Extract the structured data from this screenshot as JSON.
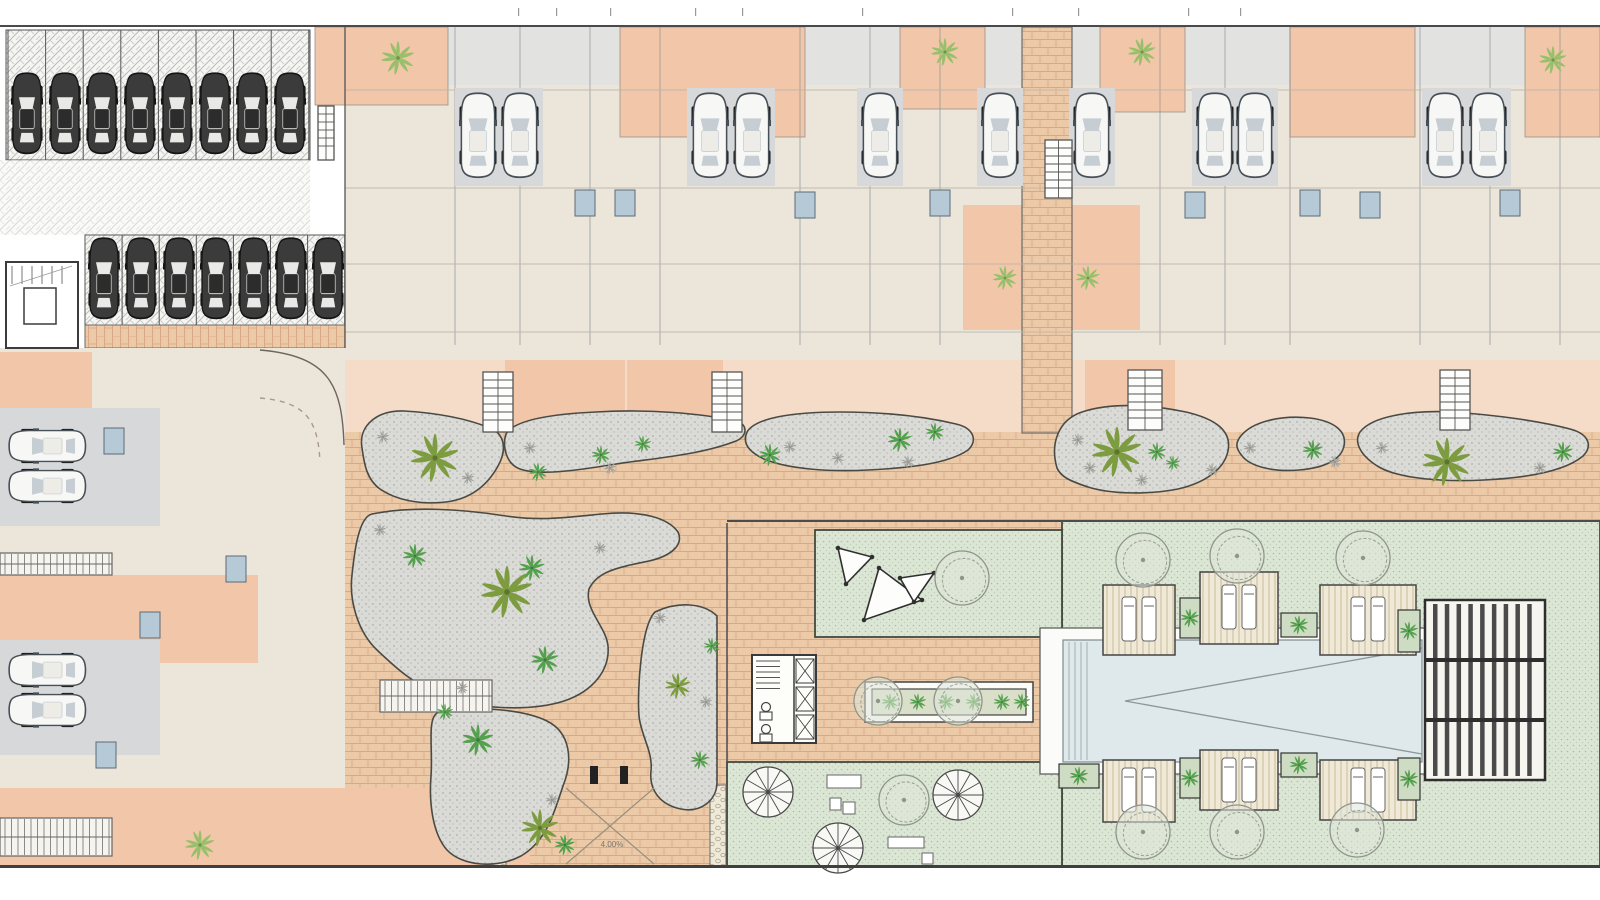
{
  "title": "Residential development site plan – ground floor",
  "canvas": {
    "w": 1600,
    "h": 900
  },
  "palette": {
    "paper": "#ffffff",
    "beige": "#ebe5da",
    "grayLight": "#e2e2e0",
    "gray": "#d7d8da",
    "salmon": "#f1c6a9",
    "salmonLight": "#f5dcc9",
    "blue": "#b5c9d6",
    "brickFill": "#ecca/a8",
    "brick": "#eccaa8",
    "brickLine": "#d9a987",
    "gravel": "#dadad6",
    "gravelDot": "#b0b0ac",
    "gravelStroke": "#4a4a45",
    "lawn": "#dce6d5",
    "lawnDot": "#a8bfa3",
    "lawnStroke": "#44493f",
    "pool": "#dfe9ec",
    "deck": "#f0e9d8",
    "deckLine": "#c8ba99",
    "pebble": "#efe9da",
    "olive": "#7d9c40",
    "green2": "#55a04e",
    "green3": "#98c06a",
    "shrubGray": "#a3a39d",
    "wall": "#63686f",
    "carDark": "#3b3b3b",
    "carLight": "#f7f7f5"
  },
  "labels": [
    {
      "x": 612,
      "y": 847,
      "text": "4.00%"
    }
  ],
  "borders": {
    "top_y": 26,
    "bottom_y": 866.5
  },
  "zones": [
    {
      "n": "plan-paper",
      "x": 0,
      "y": 25,
      "w": 1600,
      "h": 843,
      "f": "paper"
    },
    {
      "n": "parking-garage-floor",
      "x": 0,
      "y": 27,
      "w": 345,
      "h": 321,
      "f": "paper"
    },
    {
      "n": "parking-row1-paving",
      "x": 6,
      "y": 30,
      "w": 304,
      "h": 130,
      "t": "hatch",
      "sw": 1,
      "sc": "#555"
    },
    {
      "n": "parking-aisle-paving",
      "x": 0,
      "y": 160,
      "w": 310,
      "h": 75,
      "t": "hatch",
      "o": 0.55
    },
    {
      "n": "parking-row2-paving",
      "x": 85,
      "y": 235,
      "w": 260,
      "h": 90,
      "t": "hatch",
      "sw": 1,
      "sc": "#555"
    },
    {
      "n": "paver-strip",
      "x": 85,
      "y": 325,
      "w": 260,
      "h": 23,
      "t": "brickV",
      "sw": 1,
      "sc": "#6b6b66"
    },
    {
      "n": "top-units-floor",
      "x": 345,
      "y": 27,
      "w": 1255,
      "h": 333,
      "f": "beige"
    },
    {
      "n": "top-terrace-strip",
      "x": 345,
      "y": 27,
      "w": 1255,
      "h": 58,
      "f": "grayLight"
    },
    {
      "n": "patio",
      "x": 315,
      "y": 27,
      "w": 133,
      "h": 78,
      "f": "salmon",
      "sw": 0.8,
      "sc": "#999288"
    },
    {
      "n": "patio",
      "x": 620,
      "y": 27,
      "w": 185,
      "h": 110,
      "f": "salmon",
      "sw": 0.8,
      "sc": "#999288"
    },
    {
      "n": "patio",
      "x": 900,
      "y": 27,
      "w": 85,
      "h": 82,
      "f": "salmon",
      "sw": 0.8,
      "sc": "#999288"
    },
    {
      "n": "patio",
      "x": 1100,
      "y": 27,
      "w": 85,
      "h": 85,
      "f": "salmon",
      "sw": 0.8,
      "sc": "#999288"
    },
    {
      "n": "patio",
      "x": 1290,
      "y": 27,
      "w": 125,
      "h": 110,
      "f": "salmon",
      "sw": 0.8,
      "sc": "#999288"
    },
    {
      "n": "patio",
      "x": 1525,
      "y": 27,
      "w": 75,
      "h": 110,
      "f": "salmon",
      "sw": 0.8,
      "sc": "#999288"
    },
    {
      "n": "courtyard",
      "x": 963,
      "y": 205,
      "w": 60,
      "h": 125,
      "f": "salmon"
    },
    {
      "n": "courtyard",
      "x": 1072,
      "y": 205,
      "w": 68,
      "h": 125,
      "f": "salmon"
    },
    {
      "n": "rear-yard-band",
      "x": 345,
      "y": 360,
      "w": 1255,
      "h": 72,
      "f": "salmonLight"
    },
    {
      "n": "rear-yard",
      "x": 505,
      "y": 360,
      "w": 120,
      "h": 72,
      "f": "salmon"
    },
    {
      "n": "rear-yard",
      "x": 627,
      "y": 360,
      "w": 96,
      "h": 72,
      "f": "salmon"
    },
    {
      "n": "rear-yard",
      "x": 1085,
      "y": 360,
      "w": 90,
      "h": 72,
      "f": "salmon"
    },
    {
      "n": "promenade-paving",
      "x": 345,
      "y": 432,
      "w": 1255,
      "h": 91,
      "t": "brick"
    },
    {
      "n": "garden-path-paving",
      "x": 345,
      "y": 523,
      "w": 382,
      "h": 345,
      "t": "brick"
    },
    {
      "n": "pool-path-paving",
      "x": 727,
      "y": 523,
      "w": 335,
      "h": 345,
      "t": "brick"
    },
    {
      "n": "access-road",
      "x": 255,
      "y": 348,
      "w": 90,
      "h": 175,
      "f": "salmonLight"
    },
    {
      "n": "left-units-floor",
      "x": 0,
      "y": 348,
      "w": 345,
      "h": 520,
      "f": "beige"
    },
    {
      "n": "left-terrace",
      "x": 0,
      "y": 352,
      "w": 92,
      "h": 62,
      "f": "salmon"
    },
    {
      "n": "left-terrace",
      "x": 0,
      "y": 575,
      "w": 258,
      "h": 88,
      "f": "salmon"
    },
    {
      "n": "left-terrace-bottom",
      "x": 0,
      "y": 788,
      "w": 530,
      "h": 79,
      "f": "salmon"
    },
    {
      "n": "left-driveway",
      "x": 0,
      "y": 408,
      "w": 160,
      "h": 118,
      "f": "gray"
    },
    {
      "n": "left-driveway",
      "x": 0,
      "y": 640,
      "w": 160,
      "h": 115,
      "f": "gray"
    },
    {
      "n": "central-walkway",
      "x": 1022,
      "y": 27,
      "w": 50,
      "h": 406,
      "t": "brick",
      "sw": 1.2,
      "sc": "#6b6b66"
    },
    {
      "n": "pool-lawn",
      "x": 1062,
      "y": 521,
      "w": 538,
      "h": 346,
      "t": "lawn",
      "sw": 1.8,
      "sc": "#44493f"
    },
    {
      "n": "shade-sail-lawn",
      "x": 815,
      "y": 530,
      "w": 247,
      "h": 107,
      "t": "lawn",
      "sw": 1.8,
      "sc": "#44493f"
    },
    {
      "n": "bottom-lawn",
      "x": 727,
      "y": 762,
      "w": 335,
      "h": 105,
      "t": "lawn",
      "sw": 1.8,
      "sc": "#44493f"
    },
    {
      "n": "pebble-strip",
      "x": 490,
      "y": 785,
      "w": 16,
      "h": 82,
      "t": "pebble",
      "sw": 1,
      "sc": "#6b6b66"
    },
    {
      "n": "pebble-strip",
      "x": 710,
      "y": 785,
      "w": 16,
      "h": 82,
      "t": "pebble",
      "sw": 1,
      "sc": "#6b6b66"
    }
  ],
  "gravel_beds": [
    {
      "n": "gravel-bed",
      "d": "M362,448 C358,425 378,410 404,411 C438,413 468,419 490,428 C505,434 507,450 498,466 C487,486 470,499 446,502 C420,505 396,500 380,489 C366,479 364,462 362,448 Z"
    },
    {
      "n": "gravel-bed",
      "d": "M506,434 C514,420 552,414 596,412 C646,409 700,413 736,421 C748,424 748,436 736,441 C700,455 656,458 616,464 C580,470 540,476 520,469 C506,464 502,446 506,434 Z"
    },
    {
      "n": "gravel-bed",
      "d": "M747,432 C756,417 796,412 840,412 C882,412 922,416 956,424 C974,428 978,441 968,450 C948,464 908,468 868,470 C828,472 788,469 764,459 C749,452 742,443 747,432 Z"
    },
    {
      "n": "gravel-bed",
      "d": "M1057,468 C1050,444 1058,420 1082,412 C1112,402 1152,405 1186,412 C1216,419 1232,431 1228,451 C1224,470 1204,483 1178,489 C1148,495 1110,494 1088,487 C1070,481 1061,477 1057,468 Z"
    },
    {
      "n": "gravel-bed",
      "d": "M1240,437 C1252,421 1282,415 1310,418 C1334,421 1347,431 1344,446 C1341,460 1324,468 1299,470 C1274,472 1252,467 1243,457 C1236,449 1235,444 1240,437 Z"
    },
    {
      "n": "gravel-bed",
      "d": "M1360,432 C1372,416 1412,410 1452,412 C1496,415 1540,421 1570,429 C1589,434 1593,446 1583,456 C1564,472 1524,478 1484,480 C1444,482 1400,479 1379,467 C1362,457 1353,443 1360,432 Z"
    },
    {
      "n": "gravel-garden",
      "d": "M372,514 C412,506 462,509 506,516 C540,521 562,518 602,514 C642,510 668,518 678,532 C684,545 671,556 649,561 C615,568 597,572 589,589 C584,610 606,626 608,646 C610,669 594,691 564,701 C530,712 472,709 442,696 C412,683 396,668 377,650 C357,631 349,599 352,575 C354,556 358,517 372,514 Z"
    },
    {
      "n": "gravel-garden",
      "d": "M437,713 C472,705 522,709 547,721 C571,733 573,761 563,786 C553,816 546,841 521,856 C496,869 462,866 447,850 C432,833 429,801 431,776 C433,749 427,720 437,713 Z"
    },
    {
      "n": "gravel-garden",
      "d": "M655,612 C678,601 704,603 717,616 L717,782 C717,801 700,813 681,809 C661,805 649,791 651,771 C653,751 641,736 639,716 C637,691 641,626 655,612 Z"
    }
  ],
  "stairs": [
    {
      "x": 483,
      "y": 372,
      "w": 30,
      "h": 60
    },
    {
      "x": 712,
      "y": 372,
      "w": 30,
      "h": 60
    },
    {
      "x": 1128,
      "y": 370,
      "w": 34,
      "h": 60
    },
    {
      "x": 1440,
      "y": 370,
      "w": 30,
      "h": 60
    },
    {
      "x": 1045,
      "y": 140,
      "w": 27,
      "h": 58
    },
    {
      "x": 318,
      "y": 106,
      "w": 16,
      "h": 54
    }
  ],
  "ladders": [
    {
      "x": 0,
      "y": 553,
      "w": 112,
      "h": 22
    },
    {
      "x": 0,
      "y": 818,
      "w": 112,
      "h": 38
    },
    {
      "x": 380,
      "y": 680,
      "w": 112,
      "h": 32
    }
  ],
  "stair_lobby": {
    "x": 6,
    "y": 262,
    "w": 72,
    "h": 86,
    "lift": {
      "x": 24,
      "y": 288,
      "w": 32,
      "h": 36
    }
  },
  "stall_lines": {
    "row1": {
      "x0": 8,
      "step": 37.6,
      "count": 9,
      "y1": 30,
      "y2": 160
    },
    "row2": {
      "x0": 85,
      "step": 37.1,
      "count": 8,
      "y1": 235,
      "y2": 325
    }
  },
  "cars": {
    "dark": [
      [
        27,
        114
      ],
      [
        65,
        114
      ],
      [
        102,
        114
      ],
      [
        140,
        114
      ],
      [
        177,
        114
      ],
      [
        215,
        114
      ],
      [
        252,
        114
      ],
      [
        290,
        114
      ],
      [
        104,
        279
      ],
      [
        141,
        279
      ],
      [
        179,
        279
      ],
      [
        216,
        279
      ],
      [
        254,
        279
      ],
      [
        291,
        279
      ],
      [
        328,
        279
      ]
    ],
    "light_down": [
      [
        478,
        136
      ],
      [
        520,
        136
      ],
      [
        710,
        136
      ],
      [
        752,
        136
      ],
      [
        880,
        136
      ],
      [
        1000,
        136
      ],
      [
        1092,
        136
      ],
      [
        1215,
        136
      ],
      [
        1255,
        136
      ],
      [
        1445,
        136
      ],
      [
        1488,
        136
      ]
    ],
    "light_left": [
      [
        48,
        446
      ],
      [
        48,
        486
      ],
      [
        48,
        670
      ],
      [
        48,
        710
      ]
    ]
  },
  "party_walls": [
    455,
    520,
    590,
    660,
    800,
    870,
    940,
    1160,
    1225,
    1290,
    1420,
    1490,
    1560
  ],
  "hint_lines": [
    90,
    188,
    264,
    332
  ],
  "baths": [
    [
      575,
      190
    ],
    [
      615,
      190
    ],
    [
      795,
      192
    ],
    [
      930,
      190
    ],
    [
      1185,
      192
    ],
    [
      1300,
      190
    ],
    [
      1360,
      192
    ],
    [
      1500,
      190
    ],
    [
      104,
      428
    ],
    [
      140,
      612
    ],
    [
      96,
      742
    ],
    [
      226,
      556
    ]
  ],
  "palms": [
    [
      435,
      458,
      26,
      "olive"
    ],
    [
      538,
      472,
      10,
      "green2"
    ],
    [
      601,
      455,
      10,
      "green2"
    ],
    [
      643,
      444,
      9,
      "green2"
    ],
    [
      770,
      455,
      12,
      "green2"
    ],
    [
      900,
      440,
      13,
      "green2"
    ],
    [
      935,
      432,
      10,
      "green2"
    ],
    [
      1117,
      452,
      27,
      "olive"
    ],
    [
      1157,
      452,
      10,
      "green2"
    ],
    [
      1173,
      463,
      8,
      "green2"
    ],
    [
      1313,
      450,
      11,
      "green2"
    ],
    [
      1447,
      462,
      26,
      "olive"
    ],
    [
      1563,
      452,
      11,
      "green2"
    ],
    [
      507,
      592,
      28,
      "olive"
    ],
    [
      532,
      568,
      14,
      "green2"
    ],
    [
      415,
      556,
      13,
      "green2"
    ],
    [
      545,
      660,
      15,
      "green2"
    ],
    [
      540,
      828,
      20,
      "olive"
    ],
    [
      478,
      740,
      17,
      "green2"
    ],
    [
      565,
      845,
      11,
      "green2"
    ],
    [
      445,
      712,
      9,
      "green2"
    ],
    [
      678,
      686,
      14,
      "olive"
    ],
    [
      712,
      646,
      9,
      "green2"
    ],
    [
      700,
      760,
      10,
      "green2"
    ]
  ],
  "shrubs_gray": [
    [
      383,
      437
    ],
    [
      468,
      478
    ],
    [
      530,
      448
    ],
    [
      610,
      468
    ],
    [
      790,
      447
    ],
    [
      838,
      458
    ],
    [
      908,
      462
    ],
    [
      1078,
      440
    ],
    [
      1090,
      468
    ],
    [
      1142,
      480
    ],
    [
      1212,
      470
    ],
    [
      1250,
      448
    ],
    [
      1335,
      462
    ],
    [
      1382,
      448
    ],
    [
      1540,
      468
    ],
    [
      380,
      530
    ],
    [
      462,
      688
    ],
    [
      600,
      548
    ],
    [
      660,
      618
    ],
    [
      706,
      702
    ],
    [
      552,
      800
    ]
  ],
  "shrubs_green": [
    [
      398,
      58,
      18
    ],
    [
      945,
      52,
      15
    ],
    [
      1142,
      52,
      15
    ],
    [
      1553,
      60,
      15
    ],
    [
      1005,
      278,
      13
    ],
    [
      1088,
      278,
      13
    ],
    [
      200,
      845,
      16
    ]
  ],
  "trees": [
    [
      962,
      578,
      27
    ],
    [
      904,
      800,
      25
    ],
    [
      1143,
      560,
      27
    ],
    [
      1237,
      556,
      27
    ],
    [
      1363,
      558,
      27
    ],
    [
      1143,
      832,
      27
    ],
    [
      1237,
      832,
      27
    ],
    [
      1357,
      830,
      27
    ],
    [
      878,
      701,
      24
    ],
    [
      958,
      701,
      24
    ]
  ],
  "umbrellas": [
    [
      768,
      792,
      25
    ],
    [
      838,
      848,
      25
    ],
    [
      958,
      795,
      25
    ]
  ],
  "tables": [
    [
      827,
      775,
      34,
      13
    ],
    [
      830,
      798,
      11,
      12
    ],
    [
      843,
      802,
      12,
      12
    ],
    [
      888,
      837,
      36,
      11
    ],
    [
      922,
      853,
      11,
      11
    ]
  ],
  "sails": [
    {
      "pts": [
        [
          838,
          548
        ],
        [
          872,
          557
        ],
        [
          846,
          584
        ]
      ]
    },
    {
      "pts": [
        [
          879,
          568
        ],
        [
          922,
          600
        ],
        [
          864,
          620
        ]
      ]
    },
    {
      "pts": [
        [
          900,
          578
        ],
        [
          934,
          573
        ],
        [
          914,
          602
        ]
      ]
    }
  ],
  "decks": [
    {
      "x": 1103,
      "y": 585,
      "w": 72,
      "h": 70
    },
    {
      "x": 1200,
      "y": 572,
      "w": 78,
      "h": 72
    },
    {
      "x": 1320,
      "y": 585,
      "w": 96,
      "h": 70
    },
    {
      "x": 1103,
      "y": 760,
      "w": 72,
      "h": 62
    },
    {
      "x": 1200,
      "y": 750,
      "w": 78,
      "h": 60
    },
    {
      "x": 1320,
      "y": 760,
      "w": 96,
      "h": 60
    }
  ],
  "planters": [
    [
      1180,
      598,
      20,
      40
    ],
    [
      1281,
      613,
      36,
      24
    ],
    [
      1398,
      610,
      22,
      42
    ],
    [
      1059,
      764,
      40,
      24
    ],
    [
      1180,
      758,
      20,
      40
    ],
    [
      1281,
      753,
      36,
      24
    ],
    [
      1398,
      758,
      22,
      42
    ]
  ],
  "long_planter": {
    "outer": [
      865,
      682,
      168,
      40
    ],
    "inner": [
      872,
      689,
      154,
      26
    ],
    "fan_y": 702,
    "fan_xs": [
      890,
      918,
      946,
      974,
      1002,
      1022
    ]
  },
  "pool": {
    "rim": [
      1040,
      628,
      392,
      146
    ],
    "water": [
      1063,
      640,
      359,
      122
    ],
    "steps_x": [
      1069,
      1075,
      1081,
      1087
    ],
    "wedge": [
      [
        1125,
        701
      ],
      [
        1422,
        648
      ],
      [
        1422,
        754
      ]
    ]
  },
  "pergola": {
    "x": 1425,
    "y": 600,
    "w": 120,
    "h": 180,
    "bars": 9,
    "beams": [
      658,
      718
    ]
  },
  "facility": {
    "x": 752,
    "y": 655,
    "w": 64,
    "h": 88
  },
  "gate": {
    "posts": [
      [
        590,
        766
      ],
      [
        620,
        766
      ]
    ],
    "cross": [
      [
        566,
        788,
        654,
        864
      ],
      [
        654,
        788,
        566,
        864
      ]
    ]
  },
  "road_curves": [
    {
      "d": "M260,350 C330,356 342,386 344,445",
      "dash": null
    },
    {
      "d": "M260,398 C306,402 318,420 320,462",
      "dash": "5,5"
    }
  ],
  "ticks": [
    518,
    556,
    610,
    695,
    742,
    862,
    1012,
    1078,
    1188,
    1240
  ]
}
